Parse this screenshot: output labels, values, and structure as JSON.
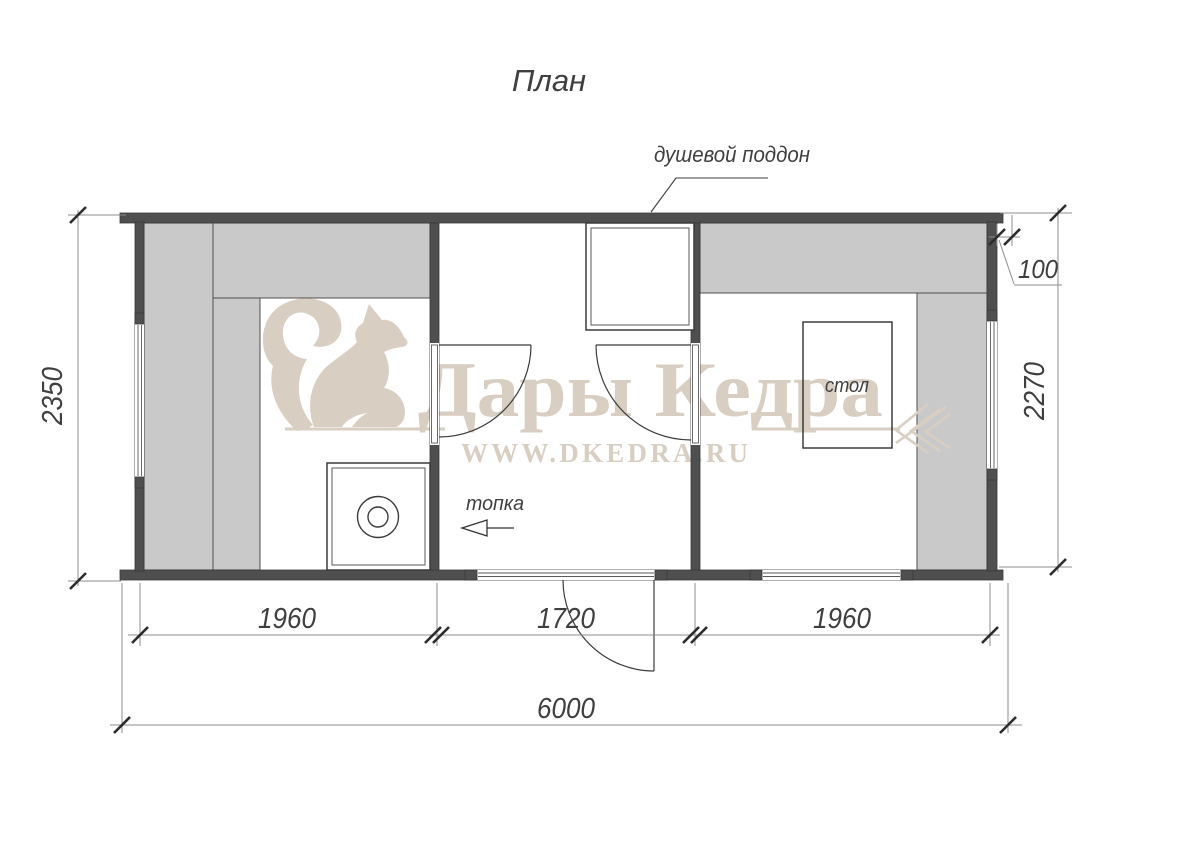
{
  "title": "План",
  "callouts": {
    "shower_tray": "душевой поддон",
    "firebox": "топка",
    "table": "стол"
  },
  "dimensions": {
    "height_left": "2350",
    "height_right": "2270",
    "wall_thickness": "100",
    "width_room_sauna": "1960",
    "width_room_washing": "1720",
    "width_room_rest": "1960",
    "width_total": "6000"
  },
  "watermark": {
    "brand": "Дары Кедра",
    "website": "WWW.DKEDRA.RU"
  },
  "colors": {
    "wall": "#4f4f4f",
    "bench": "#c9c9c9",
    "watermark": "#d8cec2",
    "linework": "#3c3c3c",
    "dimension_text": "#3f3f3f"
  }
}
